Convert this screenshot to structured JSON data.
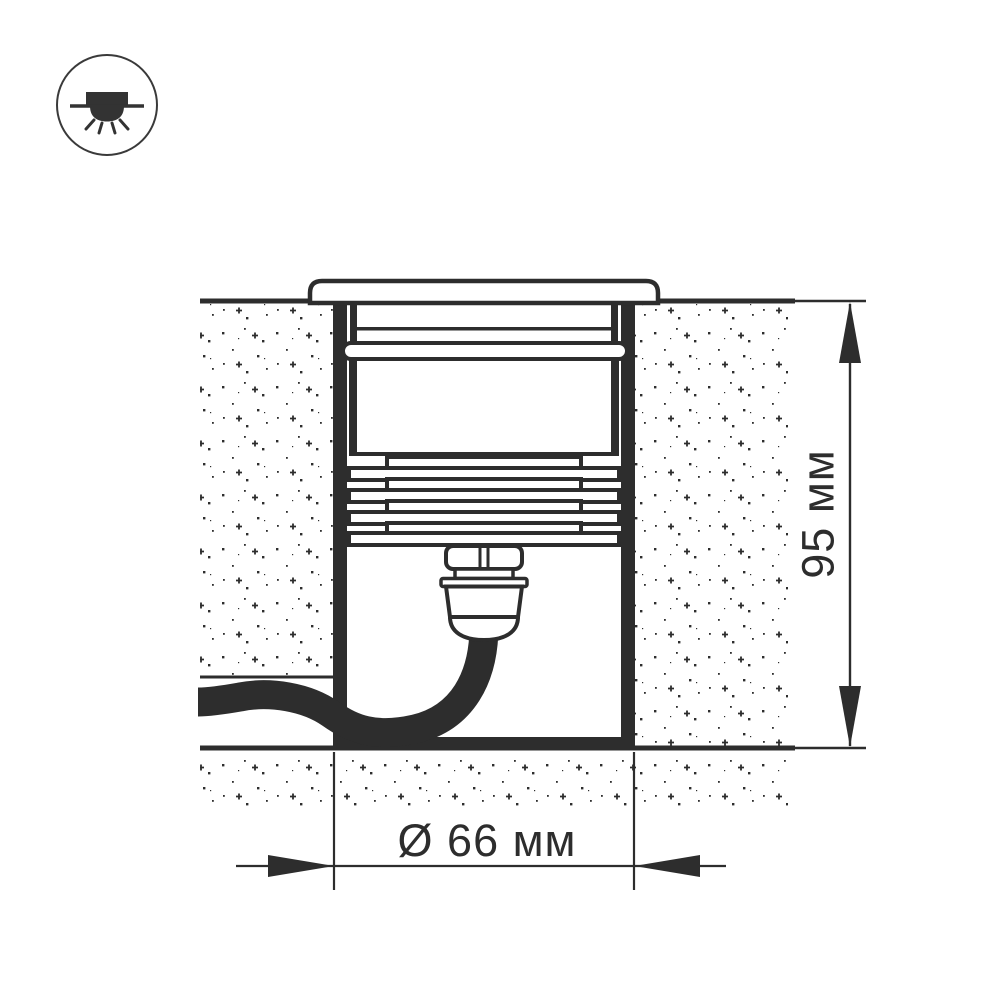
{
  "icon_badge": {
    "name": "recessed-downlight-icon"
  },
  "dimensions": {
    "height": {
      "value": "95",
      "unit": "мм",
      "label": "95 мм"
    },
    "diameter": {
      "value": "66",
      "unit": "мм",
      "symbol": "Ø",
      "label": "Ø 66 мм"
    }
  },
  "colors": {
    "ink": "#2d2d2d",
    "icon_ring": "#3a3a3a",
    "background": "#ffffff"
  }
}
